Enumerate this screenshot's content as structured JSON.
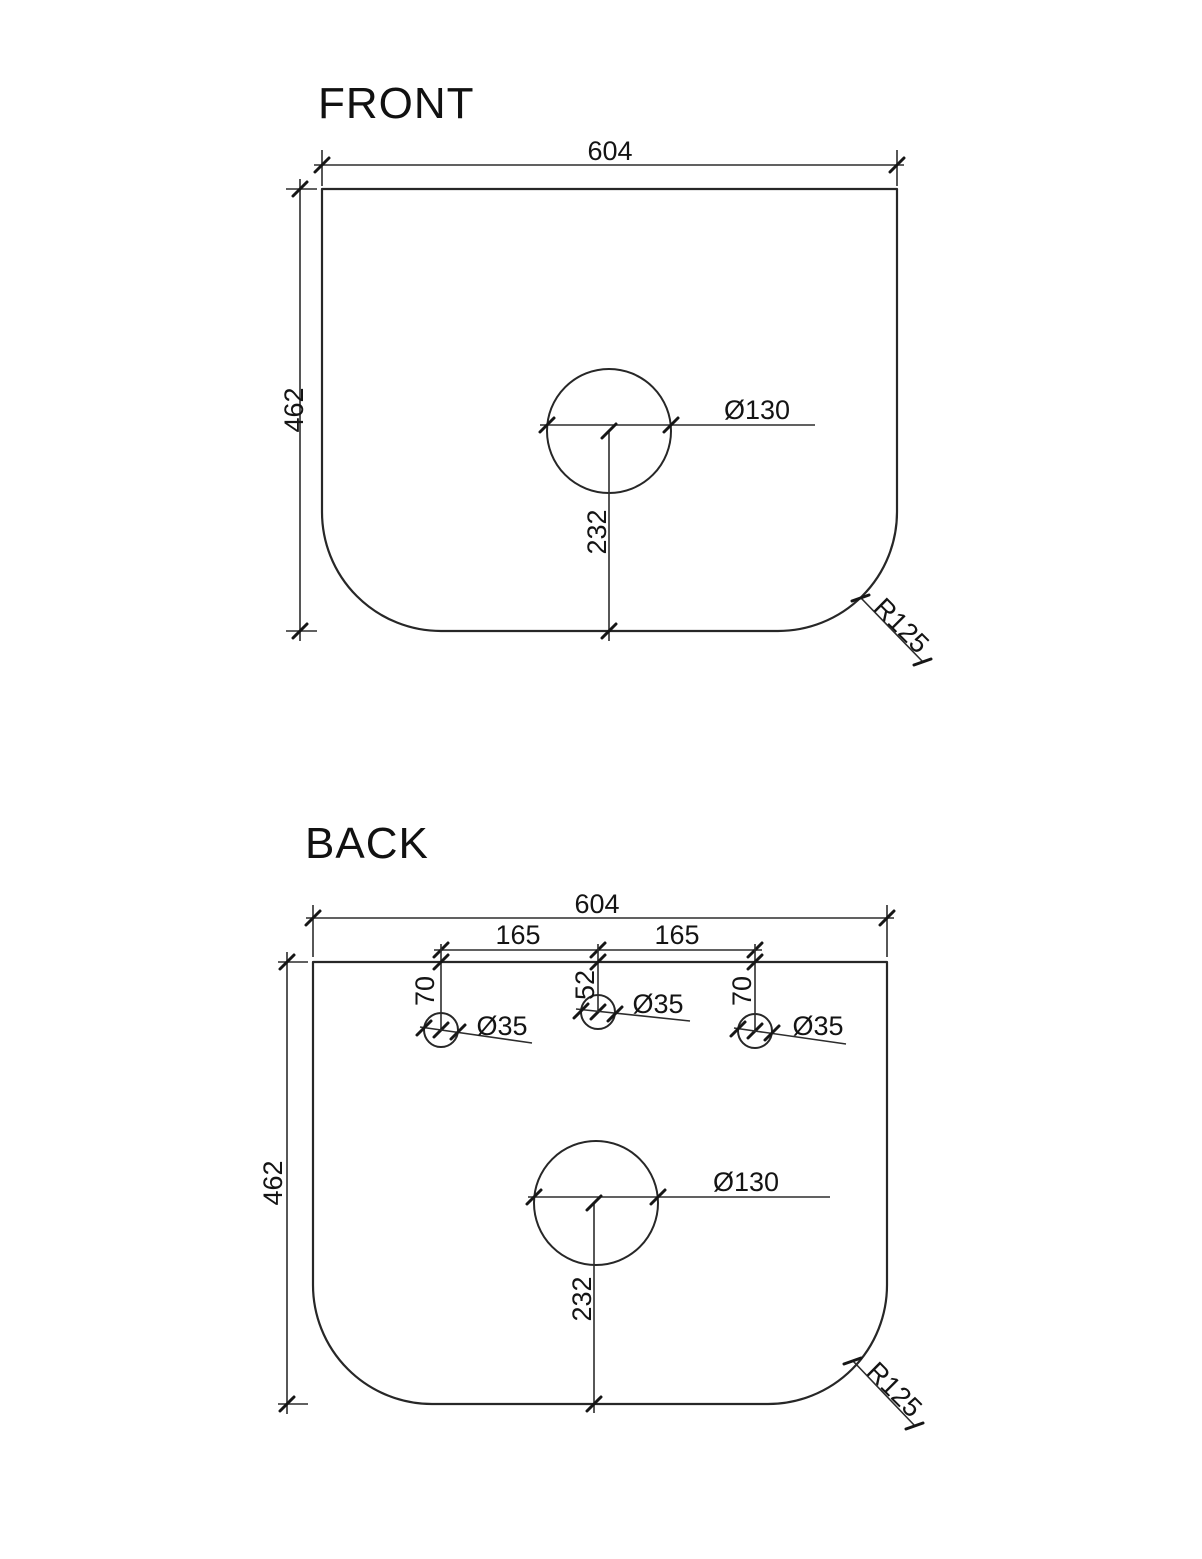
{
  "colors": {
    "background": "#ffffff",
    "line": "#2d2d2d",
    "text": "#141414"
  },
  "front_view": {
    "title": "FRONT",
    "width": "604",
    "height": "462",
    "basin_hole_diameter": "Ø130",
    "basin_hole_from_bottom": "232",
    "corner_radius": "R125"
  },
  "back_view": {
    "title": "BACK",
    "width": "604",
    "height": "462",
    "tap_spacing_left": "165",
    "tap_spacing_right": "165",
    "left_hole_from_top": "70",
    "center_hole_from_top": "52",
    "right_hole_from_top": "70",
    "left_hole_diameter": "Ø35",
    "center_hole_diameter": "Ø35",
    "right_hole_diameter": "Ø35",
    "basin_hole_diameter": "Ø130",
    "basin_hole_from_bottom": "232",
    "corner_radius": "R125"
  }
}
